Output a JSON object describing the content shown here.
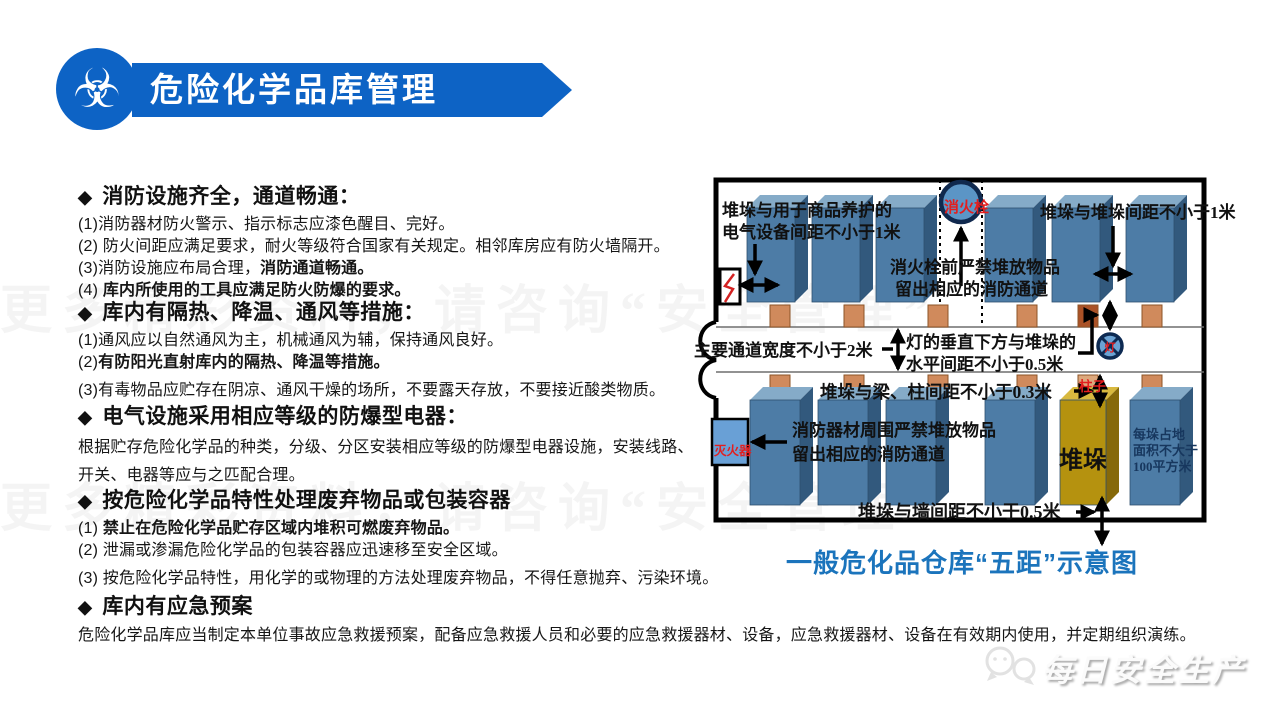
{
  "header": {
    "title": "危险化学品库管理",
    "icon": "biohazard"
  },
  "watermark": {
    "row1": "更多精彩资料，请咨询“安全管理”",
    "row2": "更多精彩资料，请咨询“安全管理”"
  },
  "sections": [
    {
      "heading": "消防设施齐全，通道畅通：",
      "items": [
        {
          "pre": "(1)消防器材防火警示、指示标志应漆色醒目、完好。",
          "bold": ""
        },
        {
          "pre": "(2) 防火间距应满足要求，耐火等级符合国家有关规定。相邻库房应有防火墙隔开。",
          "bold": ""
        },
        {
          "pre": "(3)消防设施应布局合理，",
          "bold": "消防通道畅通。"
        },
        {
          "pre": "(4) ",
          "bold": "库内所使用的工具应满足防火防爆的要求。"
        }
      ]
    },
    {
      "heading": "库内有隔热、降温、通风等措施：",
      "items": [
        {
          "pre": "(1)通风应以自然通风为主，机械通风为辅，保持通风良好。",
          "bold": ""
        },
        {
          "pre": "(2)",
          "bold": "有防阳光直射库内的隔热、降温等措施。"
        },
        {
          "pre": "(3)有毒物品应贮存在阴凉、通风干燥的场所，不要露天存放，不要接近酸类物质。",
          "bold": ""
        }
      ]
    },
    {
      "heading": "电气设施采用相应等级的防爆型电器：",
      "body": "根据贮存危险化学品的种类，分级、分区安装相应等级的防爆型电器设施，安装线路、开关、电器等应与之匹配合理。"
    },
    {
      "heading": "按危险化学品特性处理废弃物品或包装容器",
      "items": [
        {
          "pre": "(1) ",
          "bold": "禁止在危险化学品贮存区域内堆积可燃废弃物品。"
        },
        {
          "pre": "(2) 泄漏或渗漏危险化学品的包装容器应迅速移至安全区域。",
          "bold": ""
        },
        {
          "pre": "(3) 按危险化学品特性，用化学的或物理的方法处理废弃物品，不得任意抛弃、污染环境。",
          "bold": ""
        }
      ]
    },
    {
      "heading": "库内有应急预案",
      "body": "危险化学品库应当制定本单位事故应急救援预案，配备应急救援人员和必要的应急救援器材、设备，应急救援器材、设备在有效期内使用，并定期组织演练。"
    }
  ],
  "diagram": {
    "caption": "一般危化品仓库“五距”示意图",
    "labels": {
      "electric_1": "堆垛与用于商品养护的",
      "electric_2": "电气设备间距不小于1米",
      "stack_stack": "堆垛与堆垛间距不小于1米",
      "hydrant": "消火栓",
      "hydrant_front_1": "消火栓前严禁堆放物品",
      "hydrant_front_2": "留出相应的消防通道",
      "main_aisle": "主要通道宽度不小于2米",
      "lamp_1": "灯的垂直下方与堆垛的",
      "lamp_2": "水平间距不小于0.5米",
      "lamp_symbol": "灯",
      "beam_pillar": "堆垛与梁、柱间距不小于0.3米",
      "pillar": "柱子",
      "fire_equipment_1": "消防器材周围严禁堆放物品",
      "fire_equipment_2": "留出相应的消防通道",
      "extinguisher": "灭火器",
      "stack": "堆垛",
      "area_1": "每垛占地",
      "area_2": "面积不大于",
      "area_3": "100平方米",
      "wall_dist": "堆垛与墙间距不小于0.5米"
    },
    "colors": {
      "box_blue": "#4d7ca6",
      "box_gold": "#b5920f",
      "pillar_orange": "#d08a5c",
      "red_label": "#e31e1e",
      "caption_blue": "#1b74bc"
    }
  },
  "logo": {
    "text": "每日安全生产",
    "icon": "wechat-chat-bubbles"
  },
  "colors": {
    "banner_blue": "#0d63c5"
  }
}
